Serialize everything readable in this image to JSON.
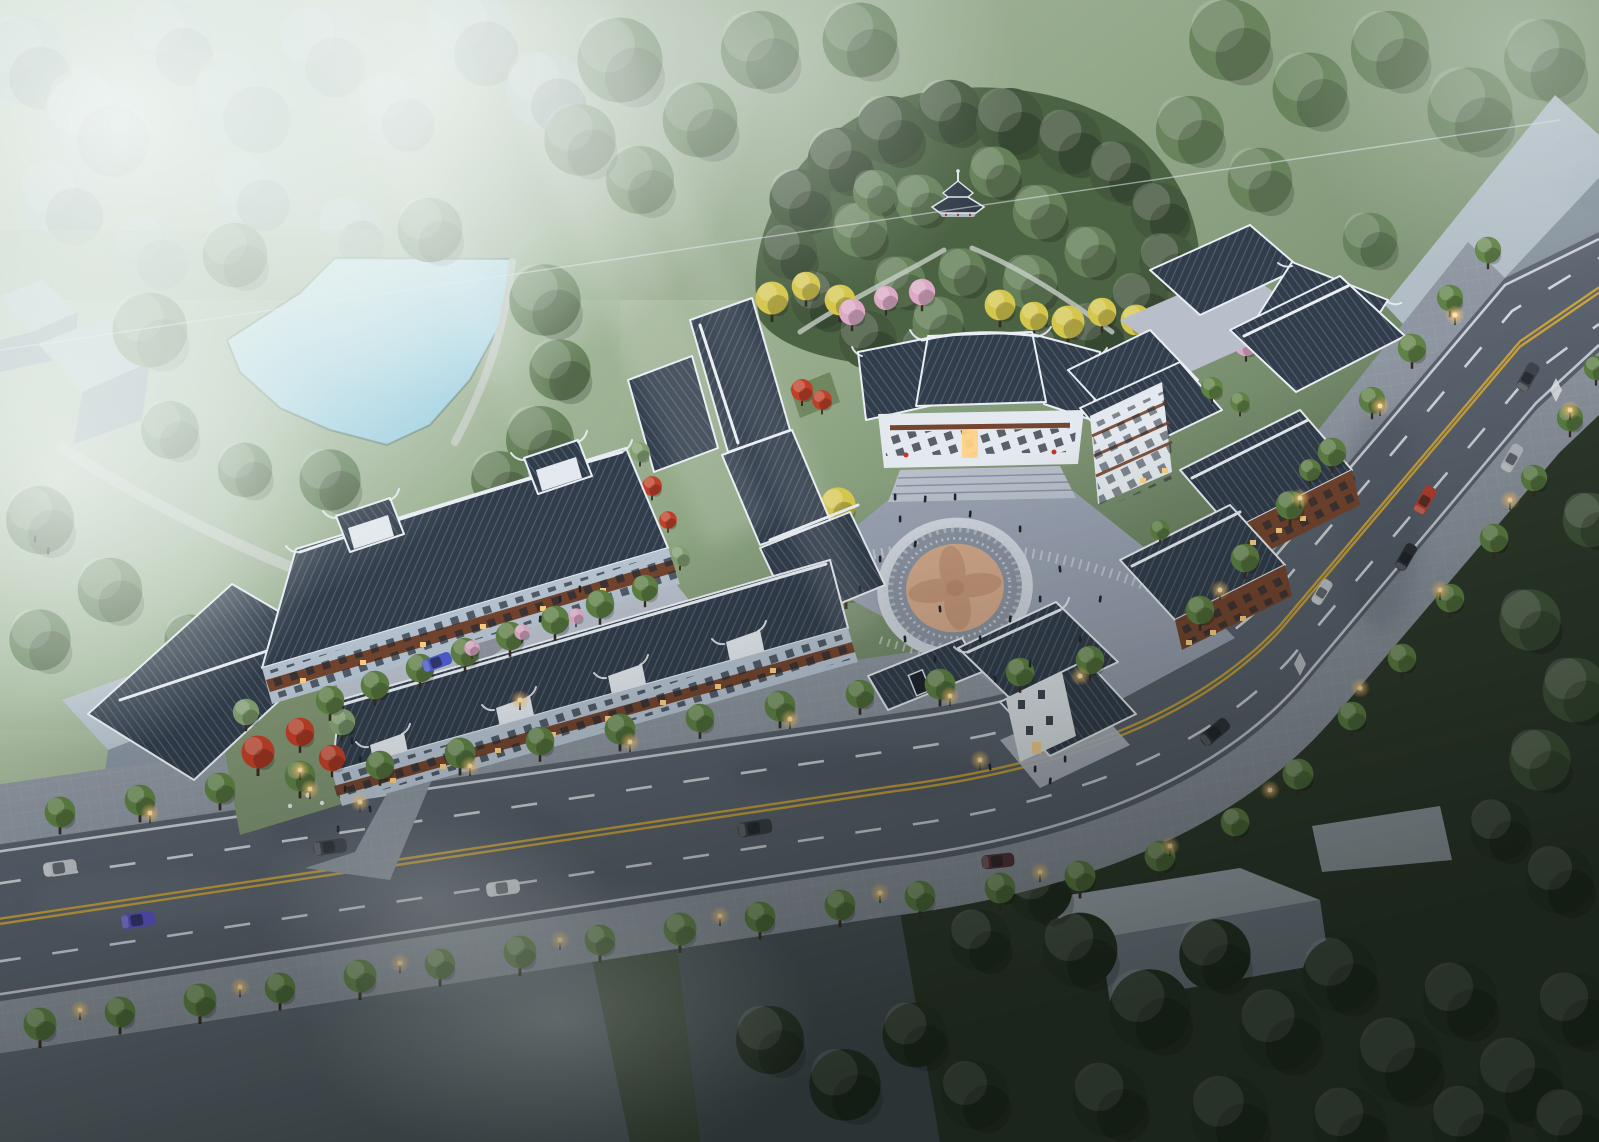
{
  "scene": {
    "description": "Misty dusk aerial rendering of a traditional Chinese-style commercial and residential complex: hilltop pavilion, pond, central circular plaza medallion, dark tiled roofs, tree-lined boulevard with lit street lamps, and untextured gray massing blocks around the site",
    "environment": {
      "time_of_day": "dusk",
      "atmosphere": "mist and warm artificial lights"
    }
  },
  "palette": {
    "mist": "#eaf2ef",
    "grass-light": "#a9bb9d",
    "grass-mid": "#7e9471",
    "grass-dark": "#3b4934",
    "forest": "#66815a",
    "forest-light": "#83a172",
    "forest-dark": "#44583d",
    "forest-deep": "#273524",
    "misty-tree": "#a7bcb2",
    "street-tree": "#5f8245",
    "lime-tree": "#9cb24c",
    "gingko": "#d5c74e",
    "blossom": "#dcaac6",
    "maple": "#bf3f28",
    "water": "#b3dcea",
    "water-light": "#d9eef5",
    "roof": "#323d4b",
    "ridge": "#e9eef4",
    "wall": "#e3e9ee",
    "wall-blue": "#b7c4d2",
    "wood": "#74452f",
    "wood-dark": "#512f22",
    "plaza": "#99a1b1",
    "plaza-light": "#b8bfcb",
    "ring": "#8a93a1",
    "ring-pale": "#cfd5dd",
    "medallion": "#d2a88a",
    "medallion-dark": "#bd8f72",
    "road": "#5a626e",
    "sidewalk": "#8e96a1",
    "lane-yellow": "#c9a23c",
    "lane-white": "#e6ebf0",
    "massing": "#b6c0cb",
    "massing-dark": "#8793a0",
    "glow": "#ffcb72",
    "window-lit": "#ffd386",
    "window-dark": "#232b36",
    "people": "#20262e",
    "path": "#c6cdc6"
  },
  "cars": [
    {
      "label": "silver sedan westbound",
      "hex": "#c2c7cd"
    },
    {
      "label": "blue-violet suv",
      "hex": "#5a52c4"
    },
    {
      "label": "dark pickup",
      "hex": "#3a3f46"
    },
    {
      "label": "white sedan",
      "hex": "#dde2e6"
    },
    {
      "label": "dark van",
      "hex": "#383c41"
    },
    {
      "label": "maroon suv at bend",
      "hex": "#54323a"
    },
    {
      "label": "black sedan at bend",
      "hex": "#2e3237"
    },
    {
      "label": "dark suv north",
      "hex": "#41464d"
    },
    {
      "label": "silver suv",
      "hex": "#b9bec5"
    },
    {
      "label": "red hatchback",
      "hex": "#b8402e"
    },
    {
      "label": "black car",
      "hex": "#2c3036"
    },
    {
      "label": "silver car south",
      "hex": "#c0c5cb"
    },
    {
      "label": "blue courtyard car",
      "hex": "#4f5ecf"
    }
  ],
  "landmarks": [
    {
      "name": "misty-woodland"
    },
    {
      "name": "pond"
    },
    {
      "name": "hilltop-pagoda"
    },
    {
      "name": "ginkgo-and-blossom-grove"
    },
    {
      "name": "main-hall"
    },
    {
      "name": "left-courtyard-block"
    },
    {
      "name": "street-front-shophouses"
    },
    {
      "name": "right-residential-block"
    },
    {
      "name": "entry-gate-pavilion"
    },
    {
      "name": "central-plaza-medallion"
    },
    {
      "name": "tree-lined-boulevard"
    },
    {
      "name": "gray-massing-blocks"
    }
  ]
}
